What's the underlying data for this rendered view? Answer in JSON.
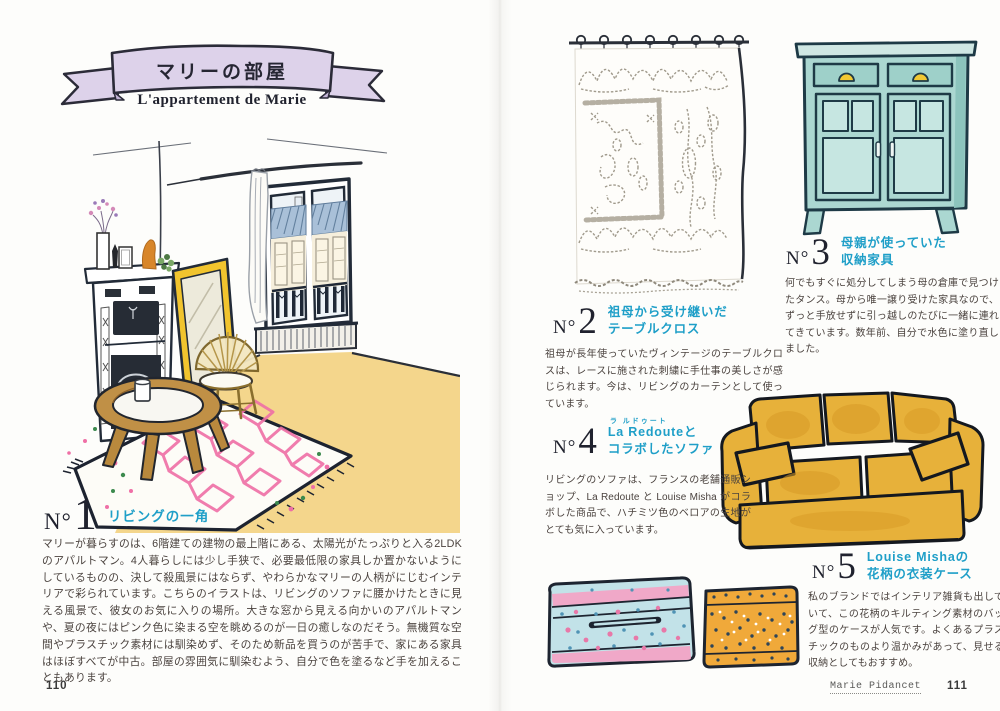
{
  "colors": {
    "accent_cyan": "#1f9fc8",
    "banner_lavender": "#ddd2ea",
    "ink_outline": "#222b38",
    "sofa_honey": "#e7b13a",
    "cabinet_teal": "#abd7d1",
    "rug_pink": "#ef6fa6",
    "floor_wheat": "#f3d382",
    "mirror_yellow": "#f1c42e",
    "case_blue": "#c2e2e8",
    "case_orange": "#f0a93a",
    "body_text": "#4a423e"
  },
  "left_page": {
    "banner_title": "マリーの部屋",
    "banner_subtitle": "L'appartement de Marie",
    "page_number": "110",
    "section1": {
      "no": "N°",
      "number": "1",
      "title": "リビングの一角",
      "body": "マリーが暮らすのは、6階建ての建物の最上階にある、太陽光がたっぷりと入る2LDK のアパルトマン。4人暮らしには少し手狭で、必要最低限の家具しか置かないようにしているものの、決して殺風景にはならず、やわらかなマリーの人柄がにじむインテリアで彩られています。こちらのイラストは、リビングのソファに腰かけたときに見える風景で、彼女のお気に入りの場所。大きな窓から見える向かいのアパルトマンや、夏の夜にはピンク色に染まる空を眺めるのが一日の癒しなのだそう。無機質な空間やプラスチック素材には馴染めず、そのため新品を買うのが苦手で、家にある家具はほぼすべてが中古。部屋の雰囲気に馴染むよう、自分で色を塗るなど手を加えることもあります。"
    }
  },
  "right_page": {
    "page_number": "111",
    "author_credit": "Marie Pidancet",
    "section2": {
      "no": "N°",
      "number": "2",
      "title_line1": "祖母から受け継いだ",
      "title_line2": "テーブルクロス",
      "body": "祖母が長年使っていたヴィンテージのテーブルクロスは、レースに施された刺繍に手仕事の美しさが感じられます。今は、リビングのカーテンとして使っています。"
    },
    "section3": {
      "no": "N°",
      "number": "3",
      "title_line1": "母親が使っていた",
      "title_line2": "収納家具",
      "body": "何でもすぐに処分してしまう母の倉庫で見つけたタンス。母から唯一譲り受けた家具なので、ずっと手放せずに引っ越しのたびに一緒に連れてきています。数年前、自分で水色に塗り直しました。"
    },
    "section4": {
      "no": "N°",
      "number": "4",
      "ruby": "ラ ルドゥート",
      "title_line1": "La Redouteと",
      "title_line2": "コラボしたソファ",
      "body": "リビングのソファは、フランスの老舗通販ショップ、La Redoute と Louise Misha がコラボした商品で、ハチミツ色のベロアの生地がとても気に入っています。"
    },
    "section5": {
      "no": "N°",
      "number": "5",
      "title_line1": "Louise Mishaの",
      "title_line2": "花柄の衣装ケース",
      "body": "私のブランドではインテリア雑貨も出していて、この花柄のキルティング素材のバッグ型のケースが人気です。よくあるプラスチックのものより温かみがあって、見せる収納としてもおすすめ。"
    }
  }
}
